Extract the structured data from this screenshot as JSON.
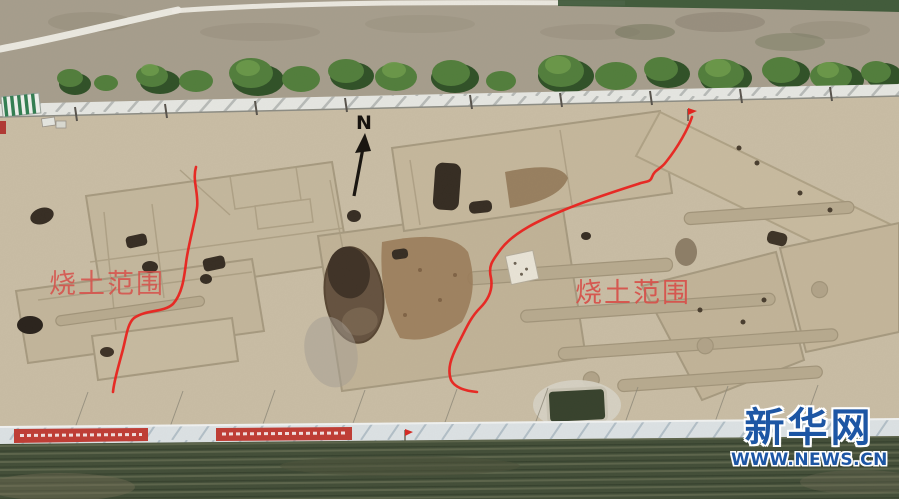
{
  "annotations": {
    "north_label": "N",
    "burnt_area_left": "烧土范围",
    "burnt_area_right": "烧土范围"
  },
  "watermark": {
    "brand": "新华网",
    "url": "WWW.NEWS.CN"
  },
  "colors": {
    "boundary_red": "#e8231f",
    "label_red": "#d7504a",
    "banner_red": "#c13931",
    "logo_blue": "#1d56a4",
    "logo_outline": "#ffffff"
  }
}
